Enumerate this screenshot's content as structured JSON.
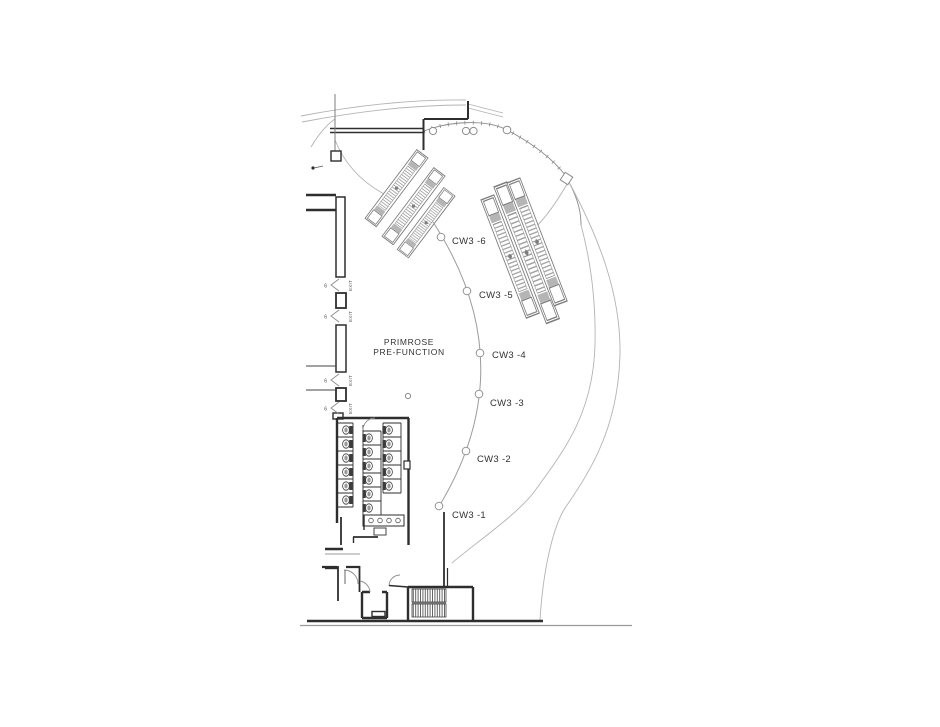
{
  "drawing": {
    "type": "architectural-floor-plan",
    "room": {
      "line1": "PRIMROSE",
      "line2": "PRE-FUNCTION"
    },
    "curtain_wall_tags": [
      {
        "label": "CW3 -6"
      },
      {
        "label": "CW3 -5"
      },
      {
        "label": "CW3 -4"
      },
      {
        "label": "CW3 -3"
      },
      {
        "label": "CW3 -2"
      },
      {
        "label": "CW3 -1"
      }
    ],
    "exits": [
      {
        "number": "6",
        "label": "EXIT"
      },
      {
        "number": "6",
        "label": "EXIT"
      },
      {
        "number": "6",
        "label": "EXIT"
      },
      {
        "number": "6",
        "label": "EXIT"
      }
    ],
    "colors": {
      "wall": "#2e2e2e",
      "light_line": "#b3b3b3",
      "mid_line": "#8c8c8c",
      "hatch": "#999999",
      "text": "#333333"
    }
  }
}
